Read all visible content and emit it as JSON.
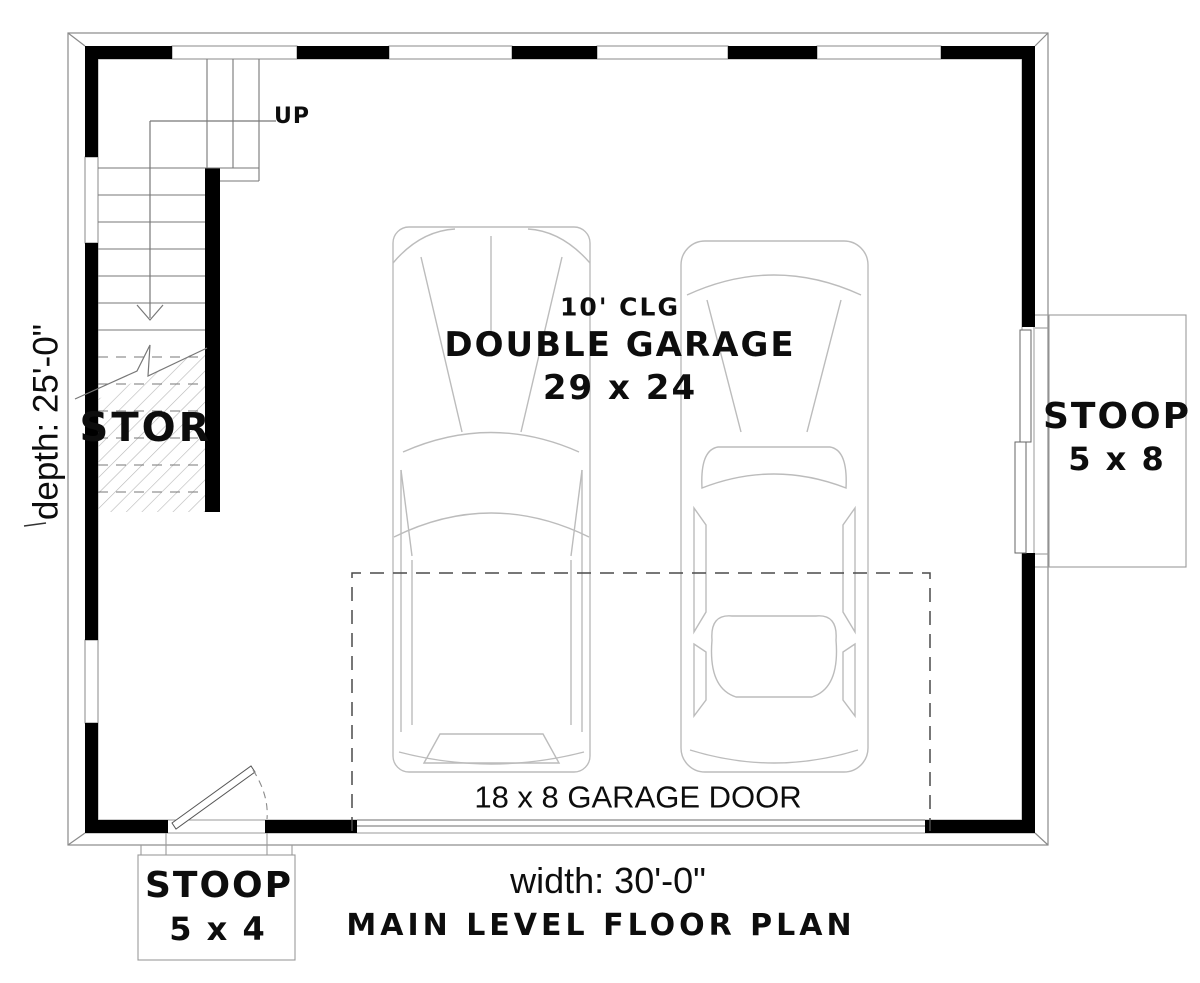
{
  "plan": {
    "title": "MAIN LEVEL FLOOR PLAN",
    "room": {
      "ceiling": "10' CLG",
      "name": "DOUBLE GARAGE",
      "size": "29 x 24"
    },
    "storage": {
      "label": "STOR"
    },
    "stair": {
      "direction": "UP"
    },
    "garage_door": {
      "label": "18 x 8 GARAGE DOOR"
    },
    "stoop_right": {
      "label": "STOOP",
      "size": "5 x 8"
    },
    "stoop_bottom": {
      "label": "STOOP",
      "size": "5 x 4"
    },
    "dimensions": {
      "depth": "depth: 25'-0\"",
      "width": "width: 30'-0\""
    },
    "colors": {
      "wall": "#000000",
      "outline": "#8a8a8a",
      "stair_line": "#777777",
      "car": "#bcbcbc",
      "hatch": "#b6b6b6",
      "dashed_clearance": "#4a4a4a",
      "text": "#111111",
      "background": "#ffffff"
    }
  }
}
